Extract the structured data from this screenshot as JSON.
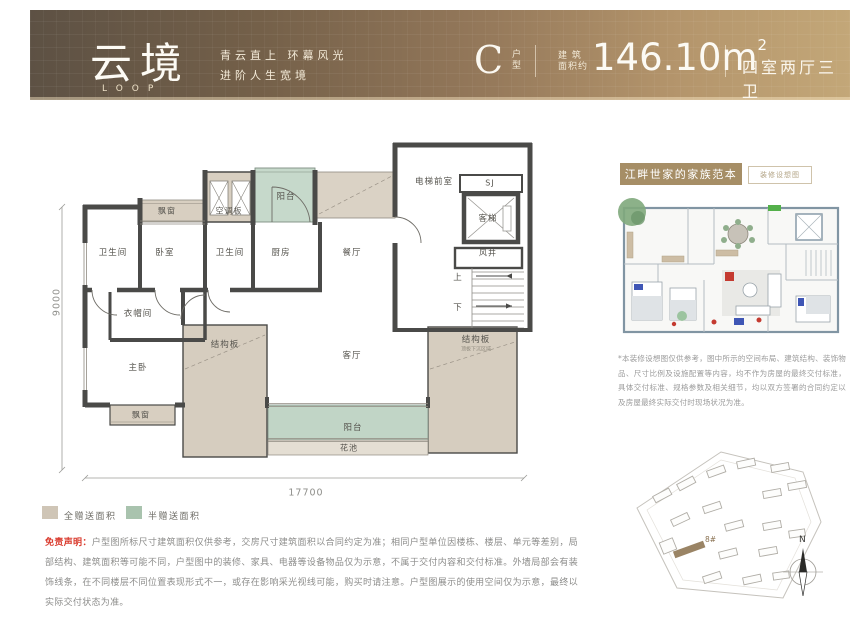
{
  "banner": {
    "title": "云境",
    "subtitle": "LOOP",
    "slogan_line1": "青云直上 环幕风光",
    "slogan_line2": "进阶人生宽境",
    "unit_letter": "C",
    "unit_suffix": "户型",
    "area_cap1": "建 筑",
    "area_cap2": "面积约",
    "area_value": "146.10m",
    "area_sup": "2",
    "rooms_spec": "四室两厅三卫"
  },
  "plan": {
    "rooms": {
      "bath1": "卫生间",
      "bedroom": "卧室",
      "bath2": "卫生间",
      "kitchen": "厨房",
      "bay_top": "飘窗",
      "ac_panel": "空调板",
      "balcony_top": "阳台",
      "dining": "餐厅",
      "elevator_lobby": "电梯前室",
      "sj": "SJ",
      "elevator": "客梯",
      "air_shaft": "风井",
      "up": "上",
      "down": "下",
      "cloak": "衣帽间",
      "master": "主卧",
      "bay_bottom": "飘窗",
      "slab_center": "结构板",
      "slab_right": "结构板",
      "slab_right_note": "顶板下沉区域",
      "living": "客厅",
      "balcony_bottom": "阳台",
      "flower_bed": "花池"
    },
    "dims": {
      "width": "17700",
      "height": "9000"
    }
  },
  "legend": {
    "full_label": "全赠送面积",
    "half_label": "半赠送面积",
    "full_color": "#cfc5b6",
    "half_color": "#a9c3ae"
  },
  "right_panel": {
    "header": "江畔世家的家族范本",
    "tag": "装修设想图",
    "note": "*本装修设想图仅供参考，图中所示的空间布局、建筑结构、装饰物品、尺寸比例及设施配置等内容，均不作为房屋的最终交付标准，具体交付标准、规格参数及相关细节，均以双方签署的合同约定以及房屋最终实际交付时现场状况为准。"
  },
  "disclaimer": {
    "label": "免责声明：",
    "text": "户型图所标尺寸建筑面积仅供参考，交房尺寸建筑面积以合同约定为准；相同户型单位因楼栋、楼层、单元等差别，局部结构、建筑面积等可能不同，户型图中的装修、家具、电器等设备物品仅为示意，不属于交付内容和交付标准。外墙局部会有装饰线条，在不同楼层不同位置表现形式不一，或存在影响采光视线可能，购买时请注意。户型图展示的使用空间仅为示意，最终以实际交付状态为准。"
  },
  "siteplan": {
    "building_label": "8#",
    "compass_n": "N"
  },
  "colors": {
    "banner_dark": "#5d5144",
    "banner_gold": "#c3a778",
    "accent_gold": "#a68e66",
    "wall": "#4a4a48",
    "slab_beige": "#d6cdbf",
    "gift_green": "#c2d6c8",
    "disclaimer_red": "#d9392c"
  }
}
